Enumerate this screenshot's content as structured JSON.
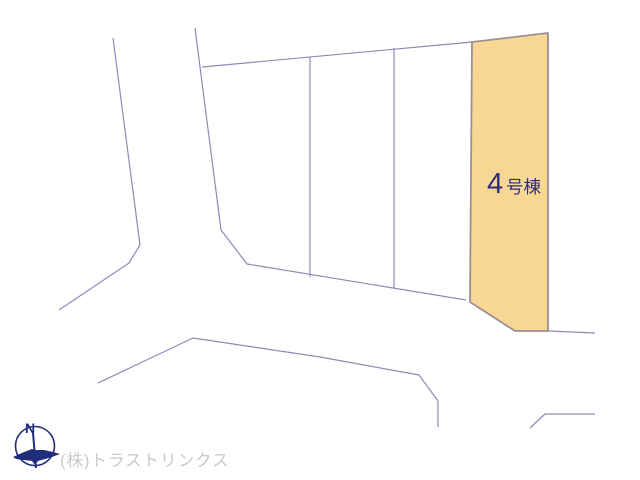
{
  "map": {
    "highlighted_parcel": {
      "number": "4",
      "suffix": "号棟",
      "full_label": "4号棟"
    },
    "compass": {
      "label": "N"
    },
    "credit": "(株)トラストリンクス"
  },
  "colors": {
    "background": "#ffffff",
    "road_line": "#8b8bba",
    "parcel_fill": "#f8d794",
    "parcel_border": "#9a9095",
    "parcel_label_text": "#2d2d7f",
    "compass": "#1f2d7b",
    "credit_text": "#c9c9c9"
  }
}
